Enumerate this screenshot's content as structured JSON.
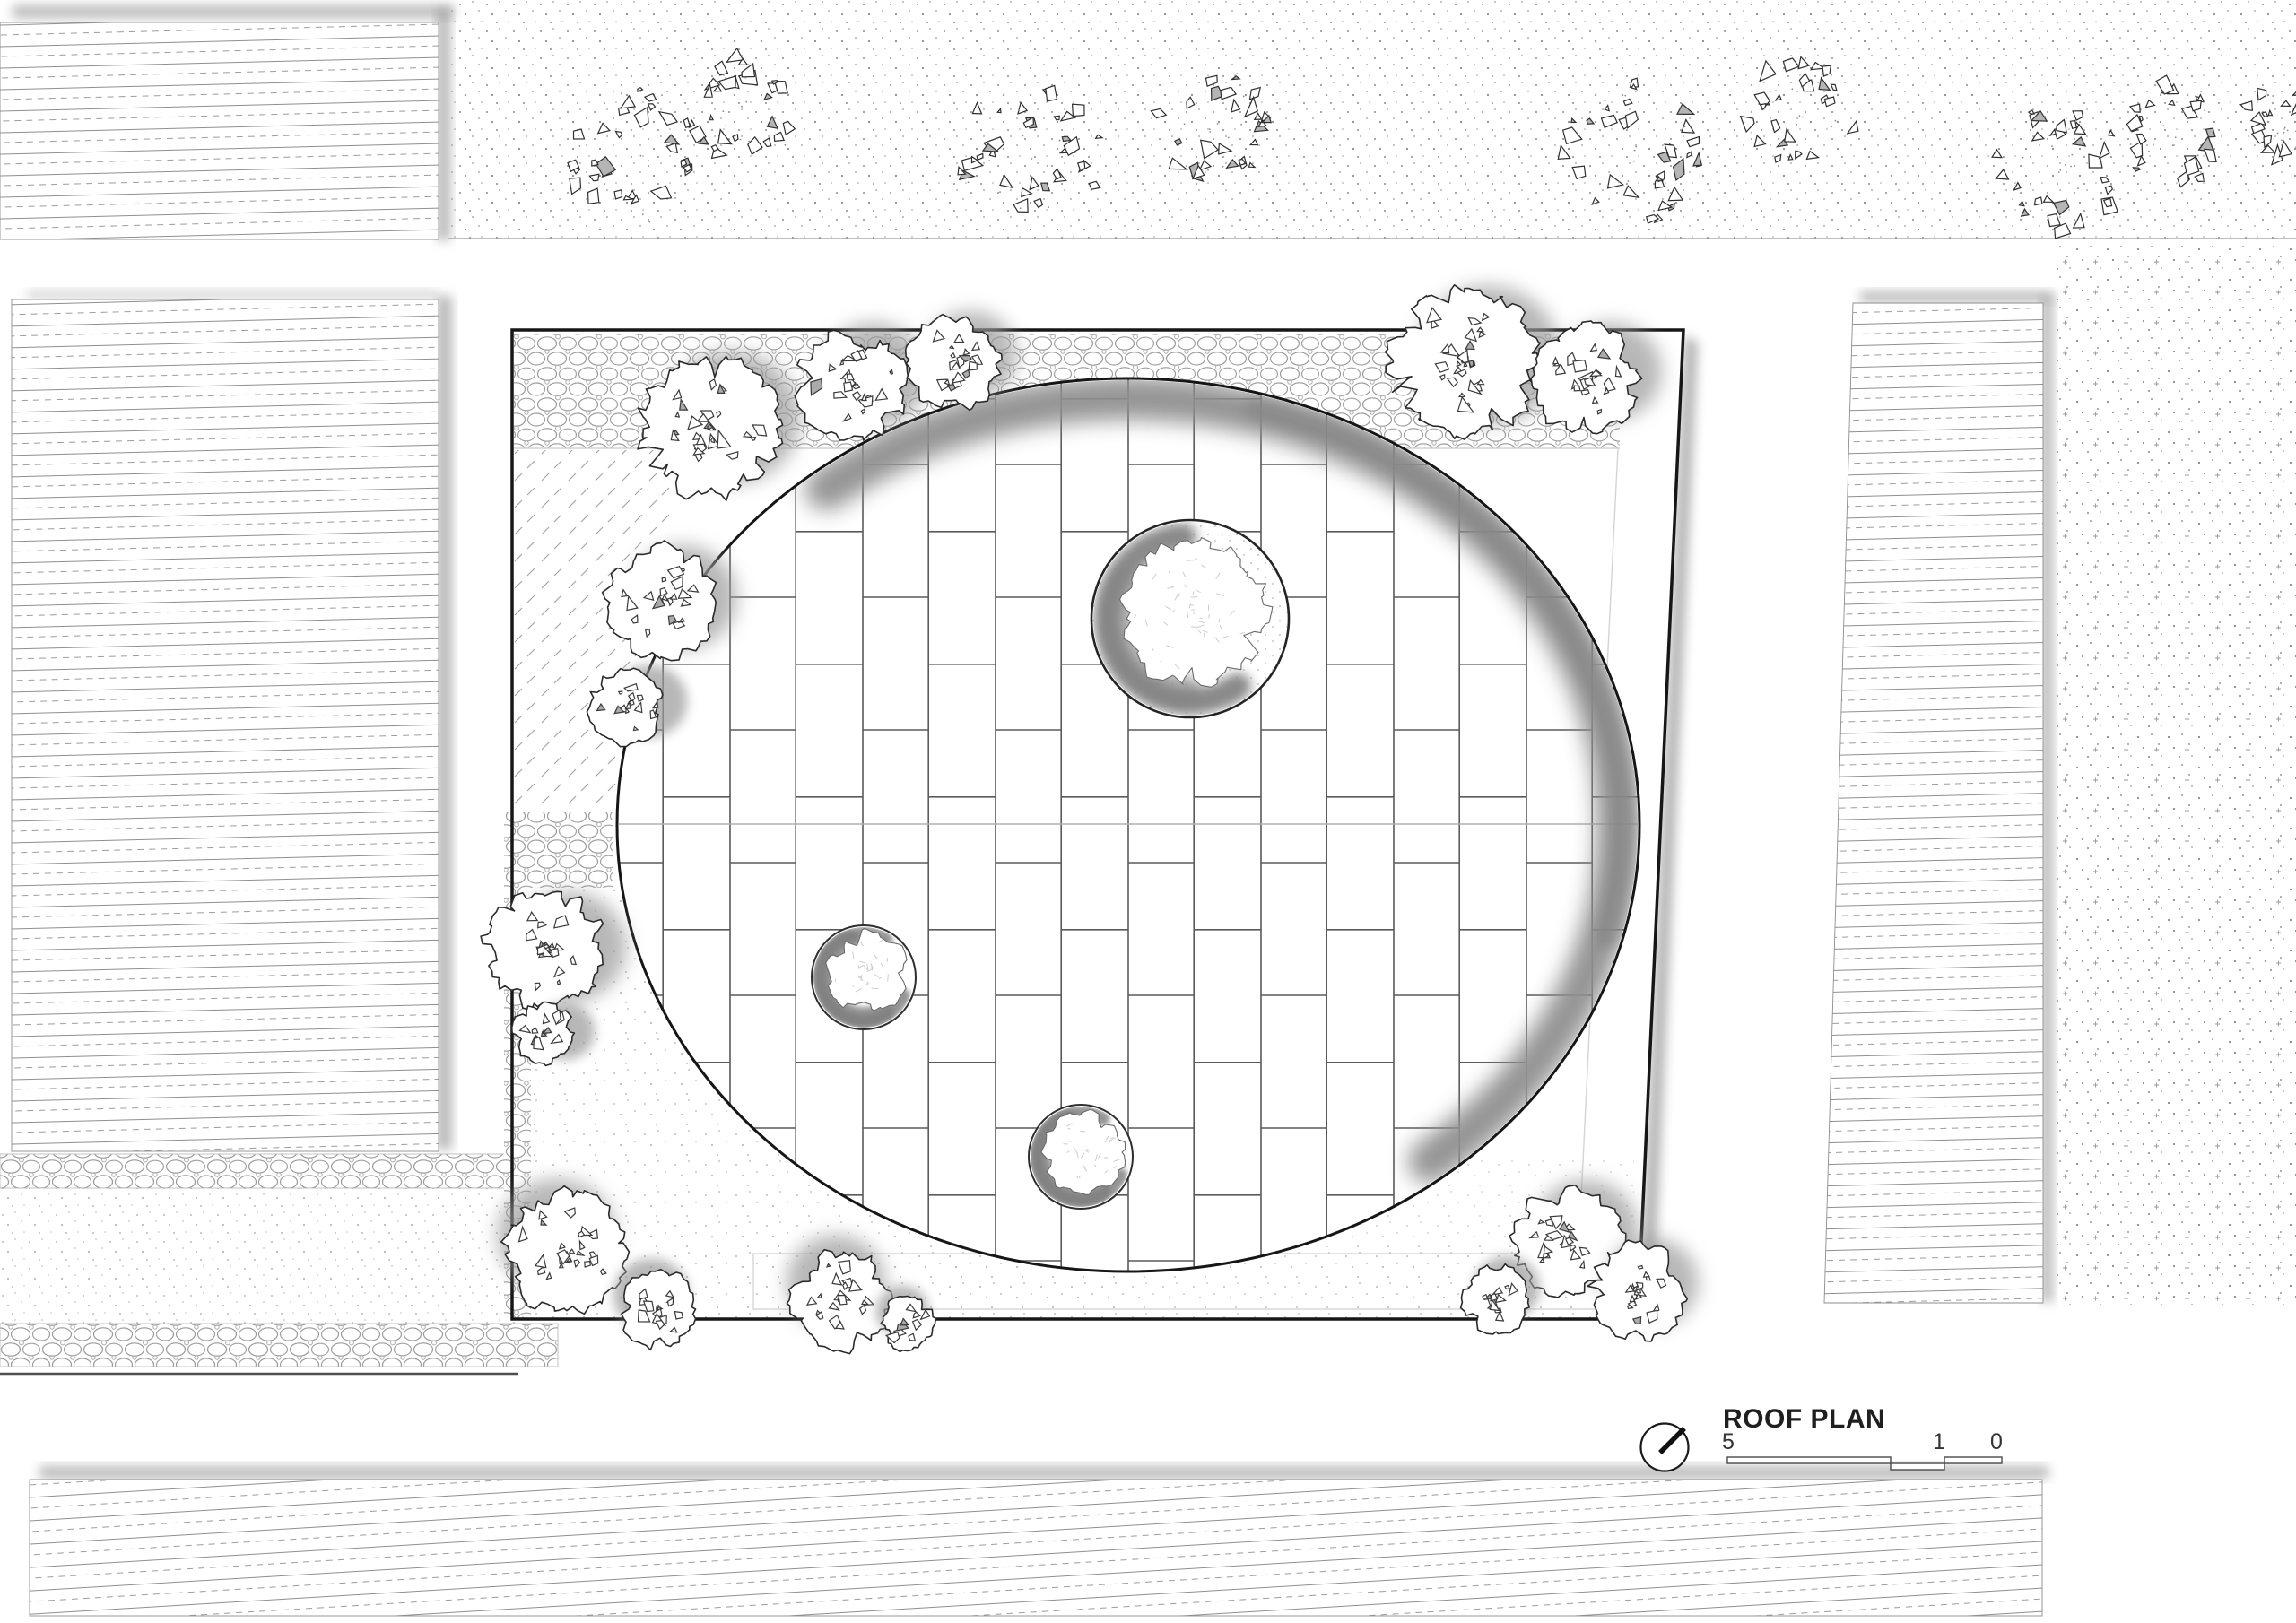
{
  "document": {
    "type": "architectural-roof-plan"
  },
  "title_block": {
    "title": "ROOF PLAN",
    "north_arrow_icon": "north-arrow-icon",
    "scale_bar": {
      "labels": [
        "5",
        "1",
        "0"
      ]
    }
  },
  "colors": {
    "paper": "#ffffff",
    "ink": "#1a1a1a",
    "hatch_gray": "#8f8f8f",
    "joint_gray": "#5a5a5a",
    "shadow_gray": "#9a9a9a",
    "stipple_gray": "#8c8c8c",
    "soft_gray": "#b8b8b8"
  },
  "textures": {
    "buildings": "horizontal-hatch",
    "planting_strips": "stipple-dots",
    "paths": "pebble-cobble",
    "lawn": "diagonal-dash",
    "courtyard": "running-bond-pavers"
  }
}
